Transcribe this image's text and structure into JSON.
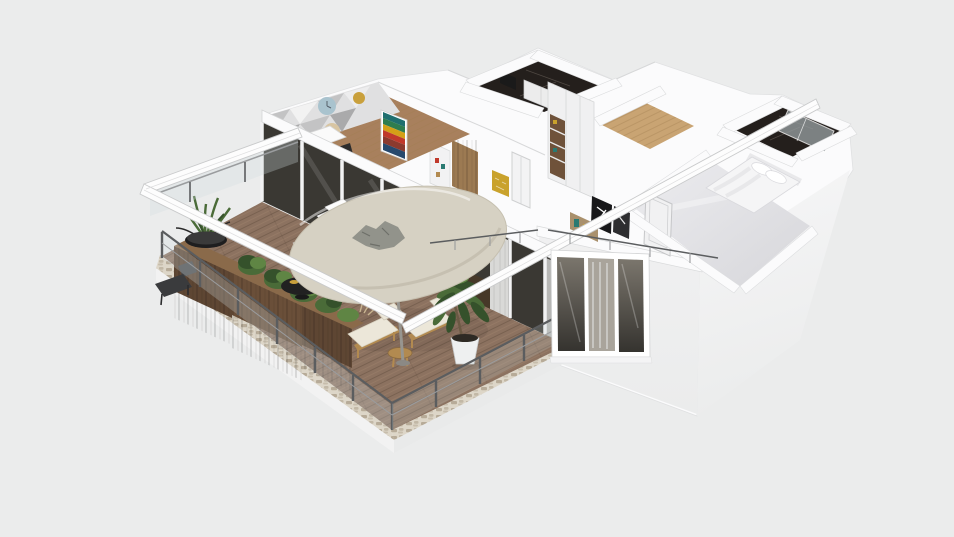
{
  "app": {
    "name": "3d-floorplan-viewer",
    "view": "isometric-orbit"
  },
  "scene": {
    "type": "3d-floor-plan-render",
    "rooms": [
      "living-dining-room",
      "hallway-closet",
      "marble-bathroom",
      "wardrobe-room",
      "wood-hallway",
      "master-bathroom",
      "bedroom",
      "terrace-balcony"
    ],
    "objects": [
      "round-canopy-table",
      "umbrella-pole",
      "lounge-chair-left",
      "lounge-chair-right",
      "wood-side-table",
      "potted-dracaena-tree",
      "wood-planter-boxes",
      "hedge-bushes",
      "sansevieria-bowl",
      "black-coffee-table",
      "outdoor-chair",
      "white-outdoor-stairs",
      "glass-railing",
      "sliding-glass-doors",
      "curtains",
      "accent-wall-clocks",
      "chevron-painting",
      "dining-table",
      "dining-chairs",
      "wardrobe-shelves",
      "hall-cabinet",
      "gold-mosaic-art",
      "white-interior-doors",
      "double-bed",
      "pillows",
      "shower-glass",
      "wall-art-frames",
      "sideboard-decor",
      "three-pane-window",
      "pergola-beams",
      "metal-handrails",
      "stone-border"
    ]
  },
  "colors": {
    "background": "#ebecec",
    "wallWhite": "#fbfbfc",
    "wallLight": "#f6f6f7",
    "wallFace": "#f0f0f1",
    "wallShade": "#e6e7e8",
    "wallLine": "#d7d8d9",
    "deck": "#8c7260",
    "deckDark": "#5f4a3a",
    "deckLight": "#b39579",
    "stone": "#ddd6c8",
    "stoneDot": "#b1a48f",
    "woodPlanter": "#5e4633",
    "woodPlanterTop": "#8a6a4a",
    "canopy": "#d6d1c3",
    "canopyEdge": "#b9b2a2",
    "canopyDeco": "#8e8f88",
    "leafDark": "#35512b",
    "leaf": "#4a6b38",
    "leafLight": "#5f8544",
    "potWhite": "#eef0f0",
    "soil": "#2e2a24",
    "cushion": "#ece7d9",
    "frameTan": "#b28a50",
    "black": "#1e1e1f",
    "darkChair": "#3a3b3d",
    "glassDark": "#3a3833",
    "glassLight": "#a9a49b",
    "curtain": "#d9d9d7",
    "curtainShade": "#b7b7b5",
    "marble": "#241f1c",
    "marbleVein": "#6a635c",
    "woodFloor": "#c9a473",
    "woodFloorLine": "#a07c4e",
    "livingFloor": "#a8805d",
    "gold": "#c9a22c",
    "teal": "#2a7a72",
    "glossA": "#ededf0",
    "glossB": "#d6d6da",
    "railMetal": "#5b5d5f",
    "railLight": "#9a9c9e",
    "glassPanel": "#cfdadd",
    "accentA": "#e0e0e1",
    "accentB": "#c3c3c4",
    "accentC": "#aaaaab",
    "circleBlue": "#a9c3ce",
    "circleBeige": "#d8c5a2",
    "circleMustard": "#c9a03c",
    "paintGreen": "#2e7d4f",
    "paintRed": "#c0392b",
    "paintTeal": "#1f6f6f",
    "paintYellow": "#d4a017",
    "paintRust": "#8b3a2e",
    "paintNavy": "#27496d",
    "bedWhite": "#f5f5f6",
    "bedShade": "#e2e2e6",
    "bedLine": "#d6d6da",
    "shower": "#939a9c",
    "white": "#ffffff"
  }
}
